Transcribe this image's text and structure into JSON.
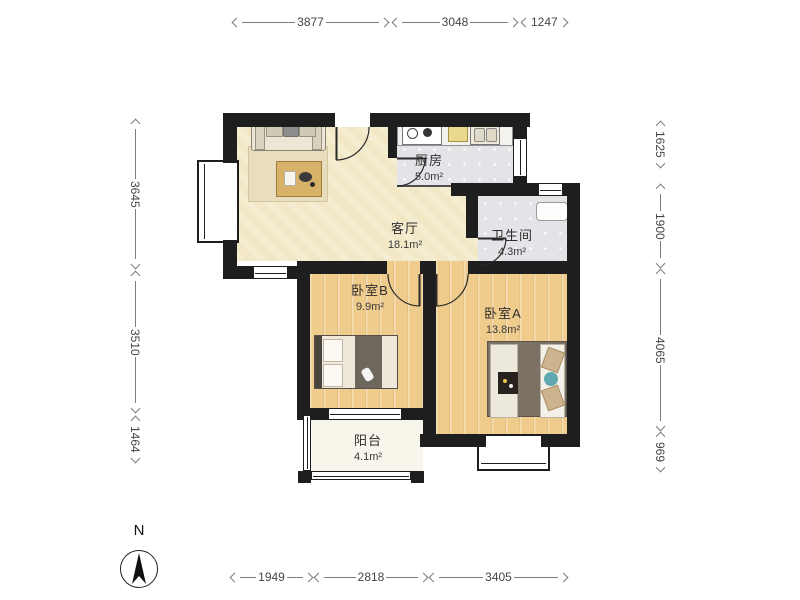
{
  "plan": {
    "rooms": [
      {
        "key": "living",
        "name": "客厅",
        "area": "18.1m²"
      },
      {
        "key": "kitchen",
        "name": "厨房",
        "area": "5.0m²"
      },
      {
        "key": "bathroom",
        "name": "卫生间",
        "area": "4.3m²"
      },
      {
        "key": "bedroom_b",
        "name": "卧室B",
        "area": "9.9m²"
      },
      {
        "key": "bedroom_a",
        "name": "卧室A",
        "area": "13.8m²"
      },
      {
        "key": "balcony",
        "name": "阳台",
        "area": "4.1m²"
      }
    ],
    "colors": {
      "wall": "#1e1e1e",
      "living_floor": "#f2e8c6",
      "wood_floor": "#efcb8c",
      "tile_floor": "#e3e4e7",
      "balcony_floor": "#f8f6ea",
      "dimension_line": "#7d7d7d",
      "dimension_text": "#454545"
    }
  },
  "dimensions": {
    "top": [
      "3877",
      "3048",
      "1247"
    ],
    "bottom": [
      "1949",
      "2818",
      "3405"
    ],
    "left": [
      "3645",
      "3510",
      "1464"
    ],
    "right": [
      "1625",
      "1900",
      "4065",
      "969"
    ]
  },
  "compass": {
    "label": "N"
  }
}
